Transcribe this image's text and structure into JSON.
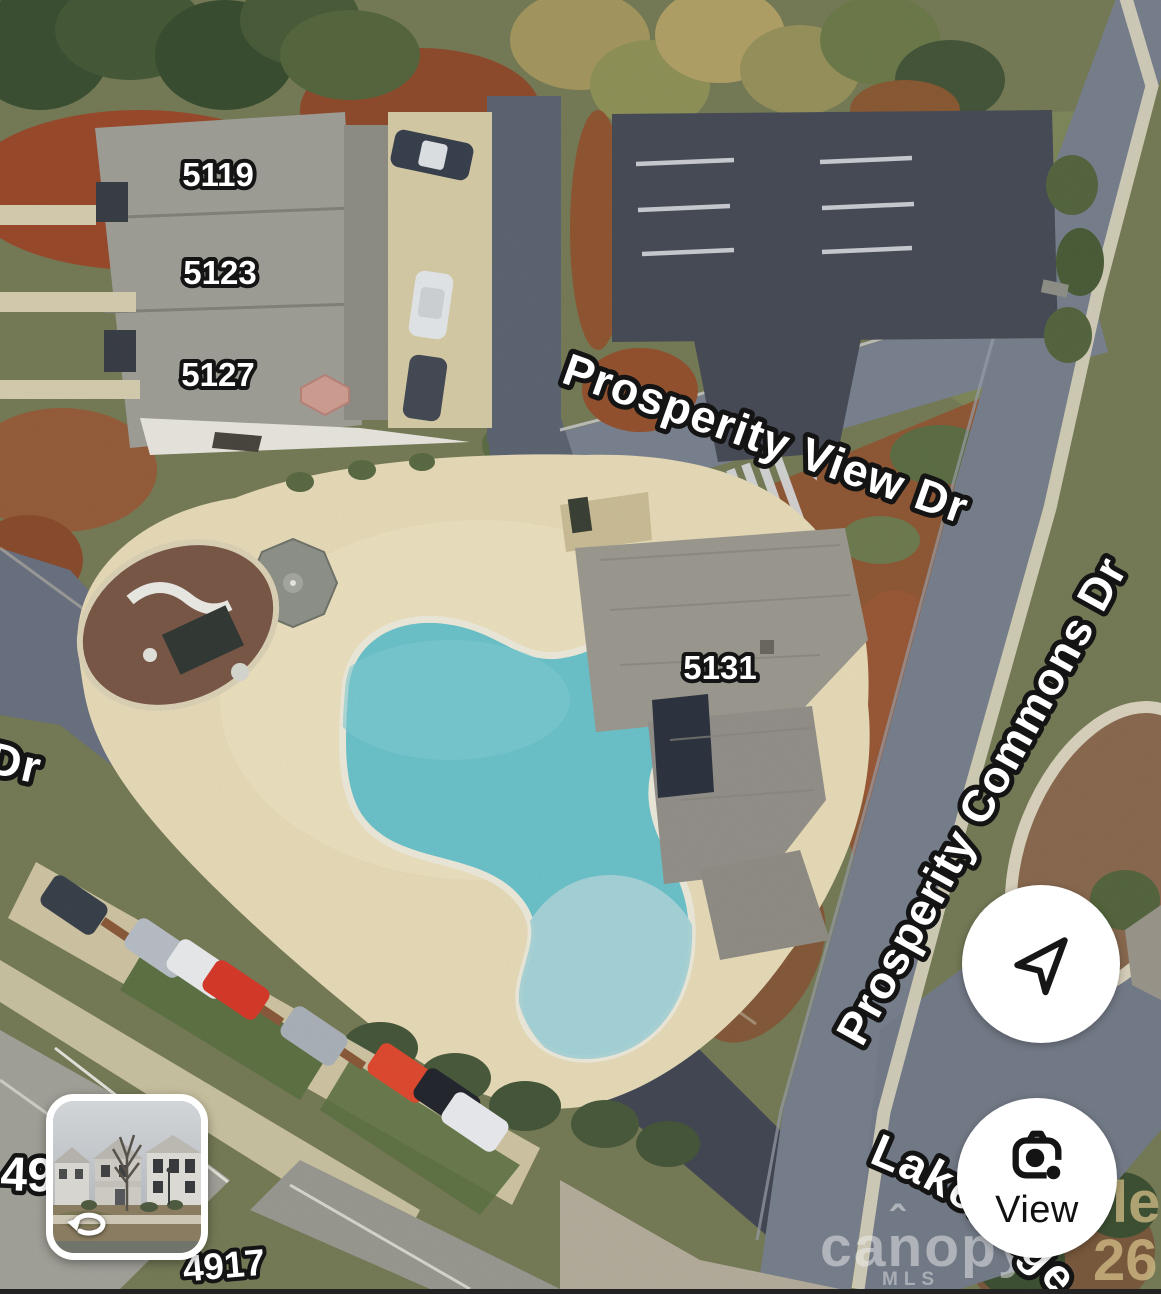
{
  "map": {
    "street_labels": {
      "view_dr": "Prosperity View Dr",
      "commons_dr": "Prosperity Commons Dr",
      "partial_dr": "Dr",
      "lakeridge": "Lakeridge"
    },
    "building_labels": {
      "b5119": "5119",
      "b5123": "5123",
      "b5127": "5127",
      "b5131": "5131",
      "b4909": "4909",
      "b4917": "4917"
    },
    "watermark": {
      "brand": "canopy",
      "caret": "ˆ",
      "sub": "MLS"
    },
    "imagery_fragments": {
      "frag1": "le",
      "frag2": "26"
    }
  },
  "controls": {
    "view_button": {
      "label": "View"
    }
  },
  "colors": {
    "road": "#78808d",
    "dark_asphalt": "#474c57",
    "pool_water": "#6cc2ca",
    "pool_shallow": "#a9d4d8",
    "deck": "#e7dbb8",
    "mulch": "#94522f",
    "label_fill": "#ffffff",
    "label_stroke": "#141414"
  }
}
